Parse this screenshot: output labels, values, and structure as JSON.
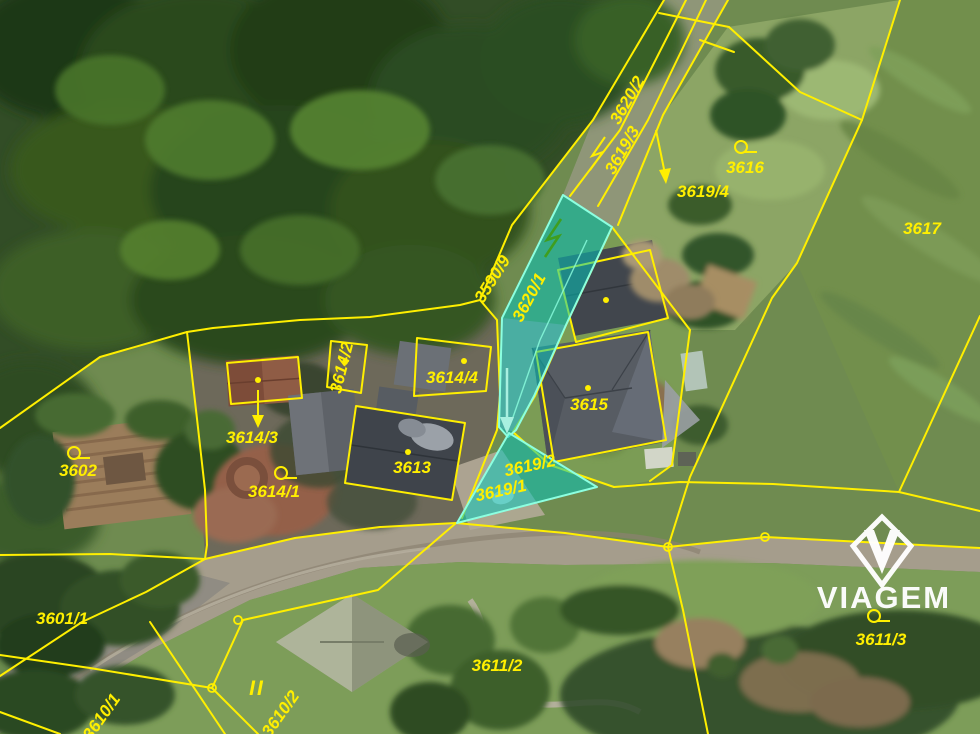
{
  "map": {
    "type": "cadastral-aerial-map",
    "boundary_color": "#ffef00",
    "highlight_fill": "#00c8be",
    "highlight_stroke": "#8cffe0",
    "highlighted_parcels": [
      "3620/1",
      "3619/2",
      "3619/1"
    ],
    "labels": [
      {
        "text": "3620/2"
      },
      {
        "text": "3619/3"
      },
      {
        "text": "3616"
      },
      {
        "text": "3619/4"
      },
      {
        "text": "3617"
      },
      {
        "text": "3590/9"
      },
      {
        "text": "3620/1"
      },
      {
        "text": "3602"
      },
      {
        "text": "3614/2"
      },
      {
        "text": "3614/4"
      },
      {
        "text": "3615"
      },
      {
        "text": "3614/3"
      },
      {
        "text": "3613"
      },
      {
        "text": "3614/1"
      },
      {
        "text": "3619/2"
      },
      {
        "text": "3619/1"
      },
      {
        "text": "3601/1"
      },
      {
        "text": "3611/2"
      },
      {
        "text": "3611/3"
      },
      {
        "text": "3610/1"
      },
      {
        "text": "3610/2"
      },
      {
        "text": "II"
      }
    ],
    "symbols": [
      "building-dot",
      "landuse-circle",
      "vertex-circle",
      "direction-arrow",
      "scrub-zigzag"
    ]
  },
  "watermark": {
    "brand": "VIAGEM"
  }
}
